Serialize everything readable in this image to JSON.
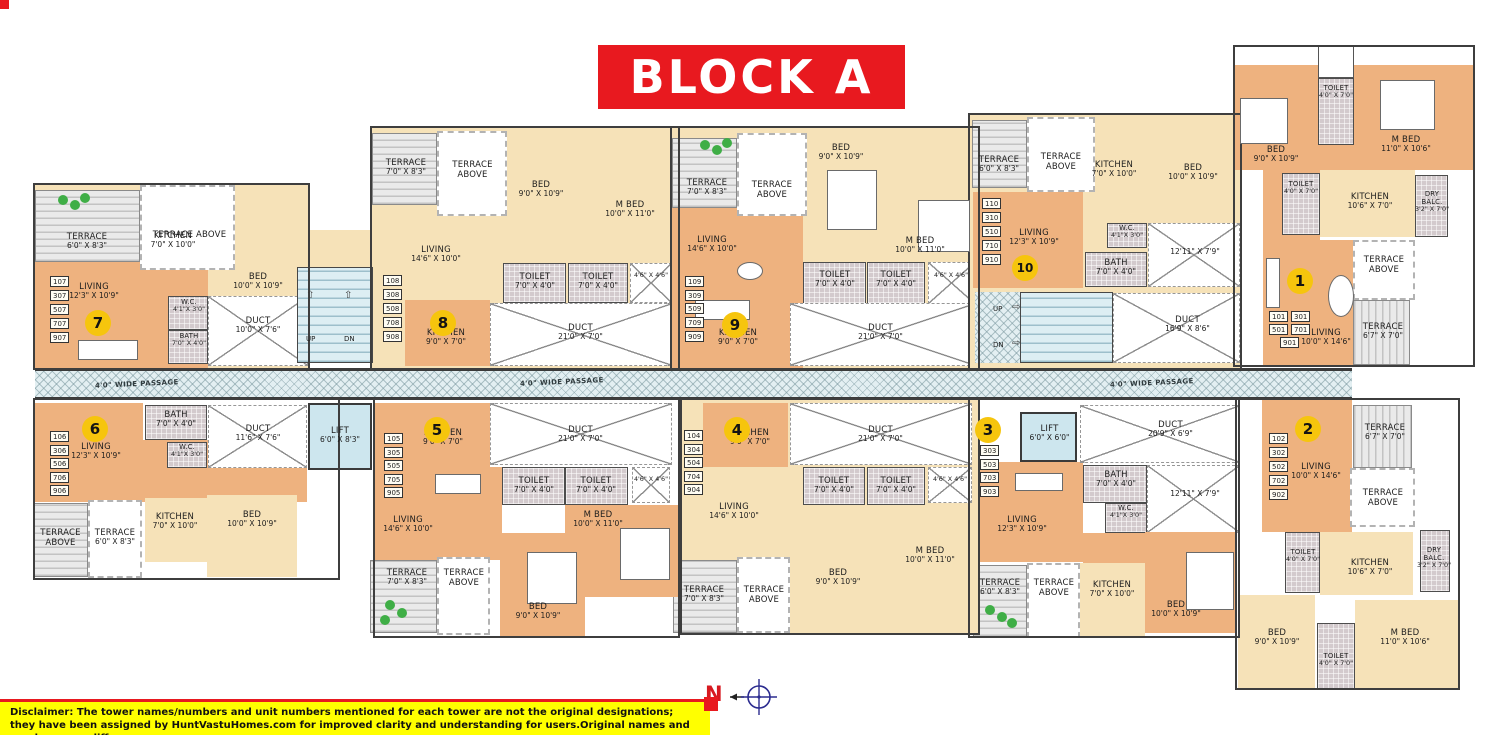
{
  "title": "BLOCK A",
  "compass": {
    "label": "N"
  },
  "disclaimer": {
    "line1": "Disclaimer: The tower names/numbers and unit numbers mentioned for each tower are not the original designations;",
    "line2": "they have been assigned by HuntVastuHomes.com for improved clarity and understanding for users.Original names and numbers may differ."
  },
  "colors": {
    "title_bg": "#e8191f",
    "badge": "#f6c50d",
    "disclaimer_bg": "#ffff00",
    "room_orange": "#eeb27f",
    "room_cream": "#f6e2b8",
    "passage_blue": "#e3eff2"
  },
  "common": {
    "passage_label": "4'0\" WIDE PASSAGE",
    "stairs": {
      "up": "UP",
      "dn": "DN"
    },
    "lift_left": {
      "name": "LIFT",
      "dims": "6'0\" X 8'3\""
    },
    "lift_right": {
      "name": "LIFT",
      "dims": "6'0\" X 6'0\""
    },
    "duct_center": {
      "name": "DUCT",
      "dims": "20'9\" X 6'9\""
    }
  },
  "units": [
    {
      "badge": "1",
      "numbers": [
        "101",
        "301",
        "501",
        "701",
        "901"
      ],
      "rooms": {
        "toilet_a": {
          "name": "TOILET",
          "dims": "4'0\" X 7'0\""
        },
        "bed": {
          "name": "BED",
          "dims": "9'0\" X 10'9\""
        },
        "mbed": {
          "name": "M BED",
          "dims": "11'0\" X 10'6\""
        },
        "toilet_b": {
          "name": "TOILET",
          "dims": "4'0\" X 7'0\""
        },
        "kitchen": {
          "name": "KITCHEN",
          "dims": "10'6\" X 7'0\""
        },
        "dry_balc": {
          "name": "DRY BALC.",
          "dims": "3'2\" X 7'0\""
        },
        "terrace_above": {
          "name": "TERRACE ABOVE"
        },
        "terrace": {
          "name": "TERRACE",
          "dims": "6'7\" X 7'0\""
        },
        "living": {
          "name": "LIVING",
          "dims": "10'0\" X 14'6\""
        }
      }
    },
    {
      "badge": "2",
      "numbers": [
        "102",
        "302",
        "502",
        "702",
        "902"
      ],
      "rooms": {
        "living": {
          "name": "LIVING",
          "dims": "10'0\" X 14'6\""
        },
        "terrace": {
          "name": "TERRACE",
          "dims": "6'7\" X 7'0\""
        },
        "terrace_above": {
          "name": "TERRACE ABOVE"
        },
        "toilet_a": {
          "name": "TOILET",
          "dims": "4'0\" X 7'0\""
        },
        "kitchen": {
          "name": "KITCHEN",
          "dims": "10'6\" X 7'0\""
        },
        "dry_balc": {
          "name": "DRY BALC.",
          "dims": "3'2\" X 7'0\""
        },
        "bed": {
          "name": "BED",
          "dims": "9'0\" X 10'9\""
        },
        "toilet_b": {
          "name": "TOILET",
          "dims": "4'0\" X 7'0\""
        },
        "mbed": {
          "name": "M BED",
          "dims": "11'0\" X 10'6\""
        }
      }
    },
    {
      "badge": "3",
      "numbers": [
        "303",
        "503",
        "703",
        "903"
      ],
      "rooms": {
        "living": {
          "name": "LIVING",
          "dims": "12'3\" X 10'9\""
        },
        "bath": {
          "name": "BATH",
          "dims": "7'0\" X 4'0\""
        },
        "wc": {
          "name": "W.C.",
          "dims": "4'1\"X 3'0\""
        },
        "duct_flat": {
          "dims": "12'11\" X 7'9\""
        },
        "terrace": {
          "name": "TERRACE",
          "dims": "6'0\" X 8'3\""
        },
        "terrace_above": {
          "name": "TERRACE ABOVE"
        },
        "kitchen": {
          "name": "KITCHEN",
          "dims": "7'0\" X 10'0\""
        },
        "bed": {
          "name": "BED",
          "dims": "10'0\" X 10'9\""
        }
      }
    },
    {
      "badge": "4",
      "numbers": [
        "104",
        "304",
        "504",
        "704",
        "904"
      ],
      "rooms": {
        "kitchen": {
          "name": "KITCHEN",
          "dims": "9'0\" X 7'0\""
        },
        "duct": {
          "name": "DUCT",
          "dims": "21'0\" X 7'0\""
        },
        "toilet_a": {
          "name": "TOILET",
          "dims": "7'0\" X 4'0\""
        },
        "toilet_b": {
          "name": "TOILET",
          "dims": "7'0\" X 4'0\""
        },
        "duct_small": {
          "dims": "4'6\" X 4'6\""
        },
        "living": {
          "name": "LIVING",
          "dims": "14'6\" X 10'0\""
        },
        "bed": {
          "name": "BED",
          "dims": "9'0\" X 10'9\""
        },
        "mbed": {
          "name": "M BED",
          "dims": "10'0\" X 11'0\""
        },
        "terrace": {
          "name": "TERRACE",
          "dims": "7'0\" X 8'3\""
        },
        "terrace_above": {
          "name": "TERRACE ABOVE"
        }
      }
    },
    {
      "badge": "5",
      "numbers": [
        "105",
        "305",
        "505",
        "705",
        "905"
      ],
      "rooms": {
        "kitchen": {
          "name": "KITCHEN",
          "dims": "9'0\" X 7'0\""
        },
        "duct": {
          "name": "DUCT",
          "dims": "21'0\" X 7'0\""
        },
        "toilet_a": {
          "name": "TOILET",
          "dims": "7'0\" X 4'0\""
        },
        "toilet_b": {
          "name": "TOILET",
          "dims": "7'0\" X 4'0\""
        },
        "duct_small": {
          "dims": "4'6\" X 4'6\""
        },
        "living": {
          "name": "LIVING",
          "dims": "14'6\" X 10'0\""
        },
        "bed": {
          "name": "BED",
          "dims": "9'0\" X 10'9\""
        },
        "mbed": {
          "name": "M BED",
          "dims": "10'0\" X 11'0\""
        },
        "terrace": {
          "name": "TERRACE",
          "dims": "7'0\" X 8'3\""
        },
        "terrace_above": {
          "name": "TERRACE ABOVE"
        }
      }
    },
    {
      "badge": "6",
      "numbers": [
        "106",
        "306",
        "506",
        "706",
        "906"
      ],
      "rooms": {
        "living": {
          "name": "LIVING",
          "dims": "12'3\" X 10'9\""
        },
        "bath": {
          "name": "BATH",
          "dims": "7'0\" X 4'0\""
        },
        "wc": {
          "name": "W.C.",
          "dims": "4'1\"X 3'0\""
        },
        "duct": {
          "name": "DUCT",
          "dims": "11'6\" X 7'6\""
        },
        "terrace_above": {
          "name": "TERRACE ABOVE"
        },
        "terrace": {
          "name": "TERRACE",
          "dims": "6'0\" X 8'3\""
        },
        "kitchen": {
          "name": "KITCHEN",
          "dims": "7'0\" X 10'0\""
        },
        "bed": {
          "name": "BED",
          "dims": "10'0\" X 10'9\""
        }
      }
    },
    {
      "badge": "7",
      "numbers": [
        "107",
        "307",
        "507",
        "707",
        "907"
      ],
      "rooms": {
        "terrace": {
          "name": "TERRACE",
          "dims": "6'0\" X 8'3\""
        },
        "terrace_above": {
          "name": "TERRACE ABOVE"
        },
        "kitchen": {
          "name": "KITCHEN",
          "dims": "7'0\" X 10'0\""
        },
        "bed": {
          "name": "BED",
          "dims": "10'0\" X 10'9\""
        },
        "living": {
          "name": "LIVING",
          "dims": "12'3\" X 10'9\""
        },
        "wc": {
          "name": "W.C.",
          "dims": "4'1\"X 3'0\""
        },
        "bath": {
          "name": "BATH",
          "dims": "7'0\" X 4'0\""
        },
        "duct": {
          "name": "DUCT",
          "dims": "10'0\" X 7'6\""
        }
      }
    },
    {
      "badge": "8",
      "numbers": [
        "108",
        "308",
        "508",
        "708",
        "908"
      ],
      "rooms": {
        "terrace": {
          "name": "TERRACE",
          "dims": "7'0\" X 8'3\""
        },
        "terrace_above": {
          "name": "TERRACE ABOVE"
        },
        "bed": {
          "name": "BED",
          "dims": "9'0\" X 10'9\""
        },
        "mbed": {
          "name": "M BED",
          "dims": "10'0\" X 11'0\""
        },
        "living": {
          "name": "LIVING",
          "dims": "14'6\" X 10'0\""
        },
        "kitchen": {
          "name": "KITCHEN",
          "dims": "9'0\" X 7'0\""
        },
        "toilet_a": {
          "name": "TOILET",
          "dims": "7'0\" X 4'0\""
        },
        "toilet_b": {
          "name": "TOILET",
          "dims": "7'0\" X 4'0\""
        },
        "duct_small": {
          "dims": "4'6\" X 4'6\""
        },
        "duct": {
          "name": "DUCT",
          "dims": "21'0\" X 7'0\""
        }
      }
    },
    {
      "badge": "9",
      "numbers": [
        "109",
        "309",
        "509",
        "709",
        "909"
      ],
      "rooms": {
        "terrace": {
          "name": "TERRACE",
          "dims": "7'0\" X 8'3\""
        },
        "terrace_above": {
          "name": "TERRACE ABOVE"
        },
        "bed": {
          "name": "BED",
          "dims": "9'0\" X 10'9\""
        },
        "mbed": {
          "name": "M BED",
          "dims": "10'0\" X 11'0\""
        },
        "living": {
          "name": "LIVING",
          "dims": "14'6\" X 10'0\""
        },
        "kitchen": {
          "name": "KITCHEN",
          "dims": "9'0\" X 7'0\""
        },
        "toilet_a": {
          "name": "TOILET",
          "dims": "7'0\" X 4'0\""
        },
        "toilet_b": {
          "name": "TOILET",
          "dims": "7'0\" X 4'0\""
        },
        "duct_small": {
          "dims": "4'6\" X 4'6\""
        },
        "duct": {
          "name": "DUCT",
          "dims": "21'0\" X 7'0\""
        }
      }
    },
    {
      "badge": "10",
      "numbers": [
        "110",
        "310",
        "510",
        "710",
        "910"
      ],
      "rooms": {
        "terrace": {
          "name": "TERRACE",
          "dims": "6'0\" X 8'3\""
        },
        "terrace_above": {
          "name": "TERRACE ABOVE"
        },
        "kitchen": {
          "name": "KITCHEN",
          "dims": "7'0\" X 10'0\""
        },
        "bed": {
          "name": "BED",
          "dims": "10'0\" X 10'9\""
        },
        "living": {
          "name": "LIVING",
          "dims": "12'3\" X 10'9\""
        },
        "wc": {
          "name": "W.C.",
          "dims": "4'1\"X 3'0\""
        },
        "bath": {
          "name": "BATH",
          "dims": "7'0\" X 4'0\""
        },
        "duct_flat": {
          "dims": "12'11\" X 7'9\""
        },
        "duct": {
          "name": "DUCT",
          "dims": "16'9\" X 8'6\""
        }
      }
    }
  ]
}
